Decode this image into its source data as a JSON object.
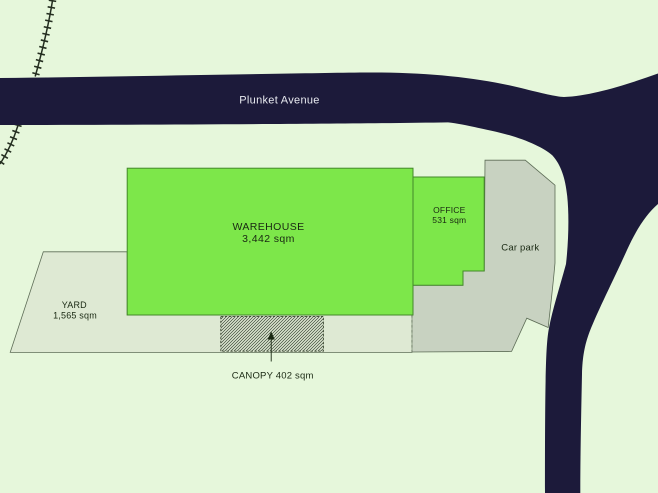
{
  "street": {
    "name": "Plunket Avenue"
  },
  "areas": {
    "warehouse": {
      "name": "WAREHOUSE",
      "size": "3,442 sqm"
    },
    "office": {
      "name": "OFFICE",
      "size": "531 sqm"
    },
    "yard": {
      "name": "YARD",
      "size": "1,565 sqm"
    },
    "car_park": {
      "name": "Car park"
    },
    "canopy": {
      "name": "CANOPY 402 sqm"
    }
  },
  "colors": {
    "background": "#e6f7db",
    "road": "#1c1a3a",
    "building": "#7de74a",
    "yard": "#dee9d3",
    "car_park": "#c8d2c1",
    "railway": "#242e20",
    "label_dark": "#192812",
    "label_light": "#e8eaf0"
  }
}
